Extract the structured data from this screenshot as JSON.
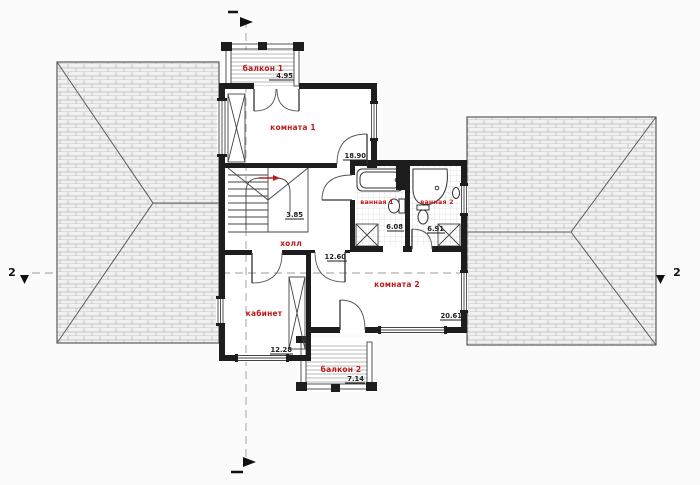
{
  "plan": {
    "title": "second-floor-plan",
    "rooms": {
      "balcony1": {
        "label": "балкон 1",
        "area": "4.95"
      },
      "room1": {
        "label": "комната 1",
        "area": "18.90"
      },
      "bath1": {
        "label": "ванная 1",
        "area": "6.08"
      },
      "bath2": {
        "label": "ванная 2",
        "area": "6.91"
      },
      "hall": {
        "label": "холл",
        "area": "12.60"
      },
      "room2": {
        "label": "комната 2",
        "area": "20.61"
      },
      "study": {
        "label": "кабинет",
        "area": "12.28"
      },
      "balcony2": {
        "label": "балкон 2",
        "area": "7.14"
      },
      "stairs": {
        "area": "3.85"
      }
    },
    "markers": {
      "section_left": "2",
      "section_right": "2"
    },
    "colors": {
      "label_red": "#c01a1a",
      "wall": "#1d1d1d",
      "roof_fill": "#f1f1f1",
      "roof_line": "#b7b7b7",
      "section_line": "#9b9b9b"
    }
  }
}
